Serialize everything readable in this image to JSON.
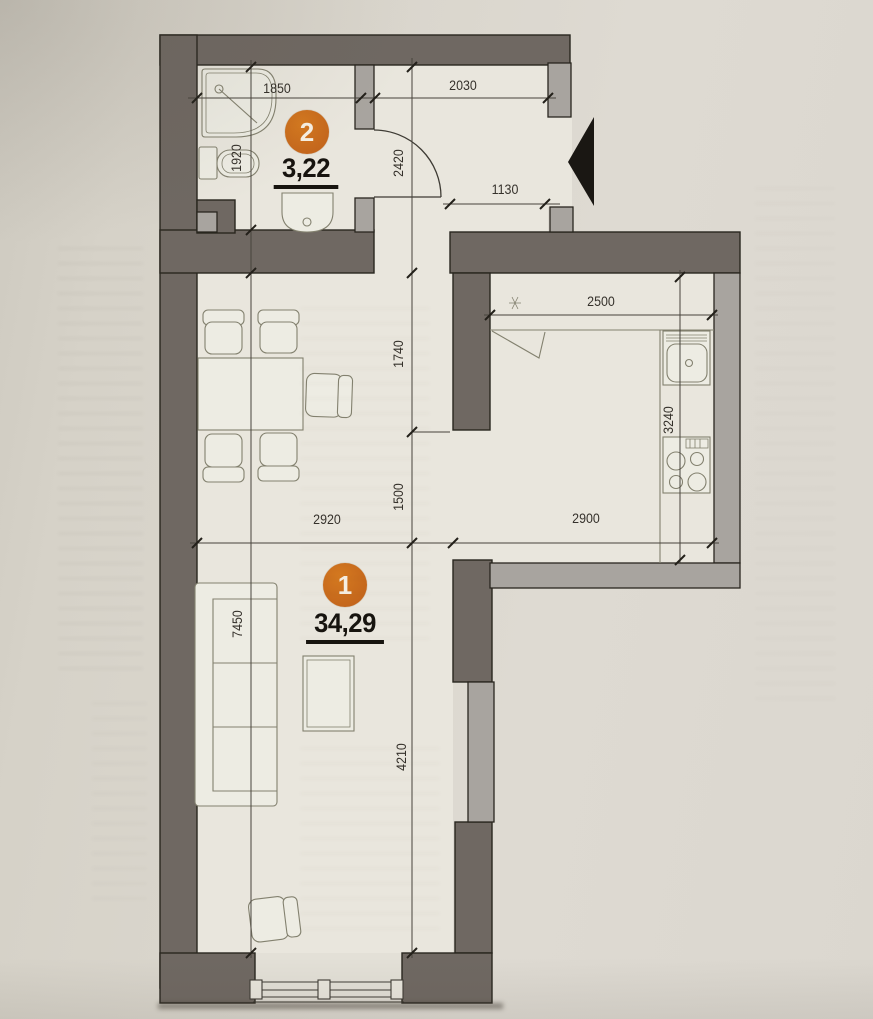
{
  "title": "apartment-floor-plan",
  "rooms": [
    {
      "badge": "2",
      "area": "3,22",
      "name": "bathroom"
    },
    {
      "badge": "1",
      "area": "34,29",
      "name": "living-room-kitchen"
    }
  ],
  "dimensions": {
    "bath_width": "1850",
    "hall_width": "2030",
    "bath_depth": "1920",
    "hall_depth": "2420",
    "entry_offset": "1130",
    "kitchen_counter": "2500",
    "kitchen_depth": "3240",
    "kitchen_wall": "1740",
    "kitchen_opening": "1500",
    "room_width": "2920",
    "kitchen_width": "2900",
    "room_depth": "7450",
    "room_lower_depth": "4210"
  },
  "colors": {
    "paper": "#d8d4cb",
    "floor": "#e9e6dd",
    "wall_dark": "#6f6862",
    "wall_light": "#a8a49f",
    "accent_orange": "#c86d1e",
    "ink": "#34302a"
  }
}
